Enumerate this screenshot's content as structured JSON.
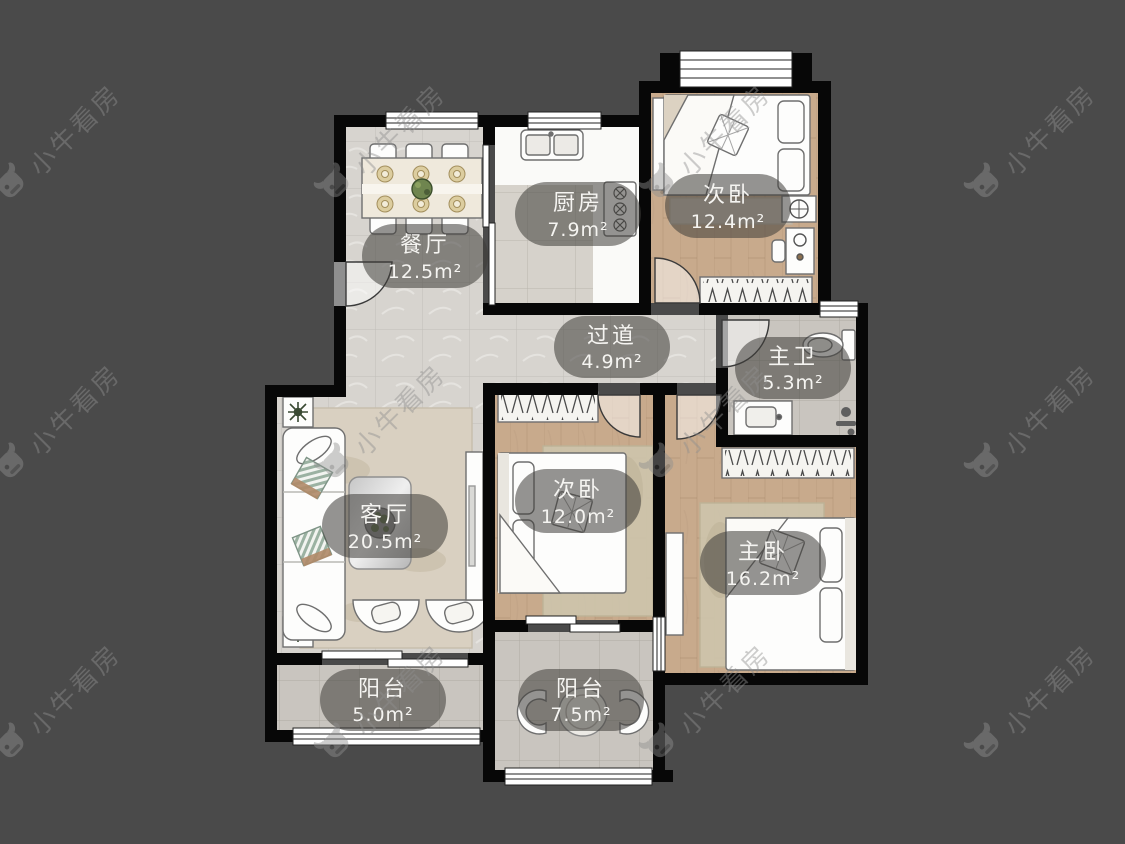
{
  "watermark": {
    "brand": "小牛看房"
  },
  "rooms": {
    "dining": {
      "name": "餐厅",
      "area": "12.5m²"
    },
    "kitchen": {
      "name": "厨房",
      "area": "7.9m²"
    },
    "bedroom_top": {
      "name": "次卧",
      "area": "12.4m²"
    },
    "hallway": {
      "name": "过道",
      "area": "4.9m²"
    },
    "master_bath": {
      "name": "主卫",
      "area": "5.3m²"
    },
    "living": {
      "name": "客厅",
      "area": "20.5m²"
    },
    "bedroom_mid": {
      "name": "次卧",
      "area": "12.0m²"
    },
    "master_bedroom": {
      "name": "主卧",
      "area": "16.2m²"
    },
    "balcony_left": {
      "name": "阳台",
      "area": "5.0m²"
    },
    "balcony_right": {
      "name": "阳台",
      "area": "7.5m²"
    }
  },
  "colors": {
    "background": "#4a4a4a",
    "wall": "#070707",
    "label_bg": "rgba(62,60,56,0.55)",
    "label_text": "#f5f4f1",
    "watermark": "#8f8f8f",
    "marble_floor": "#d7d4cf",
    "wood_floor": "#c8aa8c",
    "tile_floor": "#c9c5bf"
  }
}
